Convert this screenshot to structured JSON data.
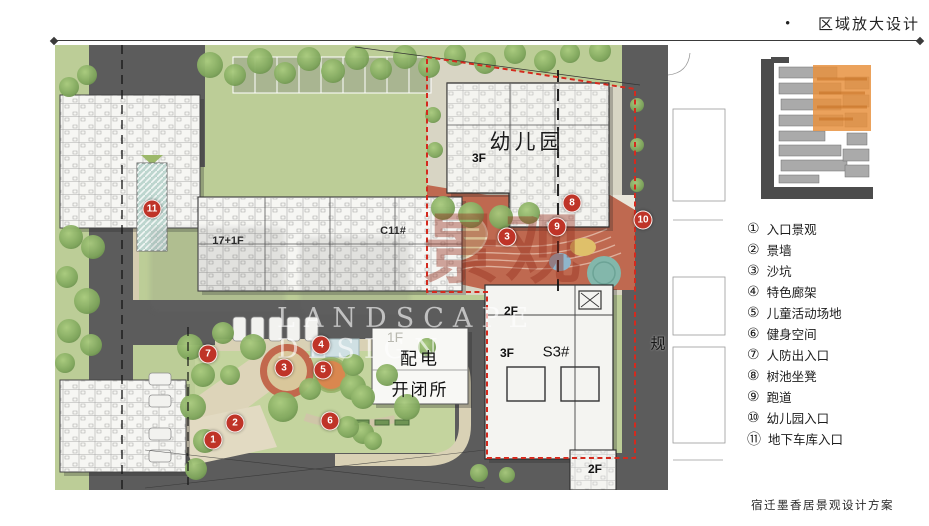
{
  "header": {
    "bullet": "•",
    "title": "区域放大设计"
  },
  "plan": {
    "watermark": {
      "en": "LANDSCAPE DESIGN",
      "cjk": "景观"
    },
    "labels": [
      {
        "t": "幼儿园",
        "x": 472,
        "y": 96,
        "s": 21,
        "w": 500,
        "c": "#1c1c1c",
        "ls": 4
      },
      {
        "t": "3F",
        "x": 424,
        "y": 113,
        "s": 12,
        "w": 700,
        "c": "#111"
      },
      {
        "t": "17+1F",
        "x": 173,
        "y": 196,
        "s": 11,
        "w": 600,
        "c": "#2a2a2a"
      },
      {
        "t": "C11#",
        "x": 338,
        "y": 186,
        "s": 11,
        "w": 600,
        "c": "#2a2a2a"
      },
      {
        "t": "1F",
        "x": 340,
        "y": 292,
        "s": 14,
        "w": 400,
        "c": "#b9b9b0"
      },
      {
        "t": "配电",
        "x": 365,
        "y": 312,
        "s": 17,
        "w": 500,
        "c": "#111",
        "ls": 3
      },
      {
        "t": "开闭所",
        "x": 365,
        "y": 343,
        "s": 17,
        "w": 500,
        "c": "#111",
        "ls": 2
      },
      {
        "t": "2F",
        "x": 456,
        "y": 266,
        "s": 12,
        "w": 700,
        "c": "#111"
      },
      {
        "t": "3F",
        "x": 452,
        "y": 308,
        "s": 12,
        "w": 700,
        "c": "#111"
      },
      {
        "t": "S3#",
        "x": 501,
        "y": 307,
        "s": 15,
        "w": 500,
        "c": "#111"
      },
      {
        "t": "2F",
        "x": 540,
        "y": 424,
        "s": 12,
        "w": 700,
        "c": "#111"
      },
      {
        "t": "规",
        "x": 603,
        "y": 298,
        "s": 15,
        "w": 500,
        "c": "#161616"
      }
    ],
    "markers": [
      {
        "n": "1",
        "x": 158,
        "y": 395
      },
      {
        "n": "2",
        "x": 180,
        "y": 378
      },
      {
        "n": "3",
        "x": 229,
        "y": 323
      },
      {
        "n": "4",
        "x": 266,
        "y": 300
      },
      {
        "n": "5",
        "x": 268,
        "y": 325
      },
      {
        "n": "6",
        "x": 275,
        "y": 376
      },
      {
        "n": "7",
        "x": 153,
        "y": 309
      },
      {
        "n": "3",
        "x": 452,
        "y": 192
      },
      {
        "n": "8",
        "x": 517,
        "y": 158
      },
      {
        "n": "9",
        "x": 502,
        "y": 182
      },
      {
        "n": "10",
        "x": 588,
        "y": 175
      },
      {
        "n": "11",
        "x": 97,
        "y": 164
      }
    ]
  },
  "legend": {
    "items": [
      {
        "num": "①",
        "label": "入口景观"
      },
      {
        "num": "②",
        "label": "景墙"
      },
      {
        "num": "③",
        "label": "沙坑"
      },
      {
        "num": "④",
        "label": "特色廊架"
      },
      {
        "num": "⑤",
        "label": "儿童活动场地"
      },
      {
        "num": "⑥",
        "label": "健身空间"
      },
      {
        "num": "⑦",
        "label": "人防出入口"
      },
      {
        "num": "⑧",
        "label": "树池坐凳"
      },
      {
        "num": "⑨",
        "label": "跑道"
      },
      {
        "num": "⑩",
        "label": "幼儿园入口"
      },
      {
        "num": "⑪",
        "label": "地下车库入口"
      }
    ]
  },
  "footer": {
    "title": "宿迁墨香居景观设计方案"
  },
  "colors": {
    "marker_red": "#bf3428",
    "boundary_red": "#d42a1e",
    "road_gray": "#5c5c5c",
    "grass_green": "#bccd97",
    "keymap_highlight_orange": "#e8923f",
    "playground_red": "#bf6950"
  }
}
